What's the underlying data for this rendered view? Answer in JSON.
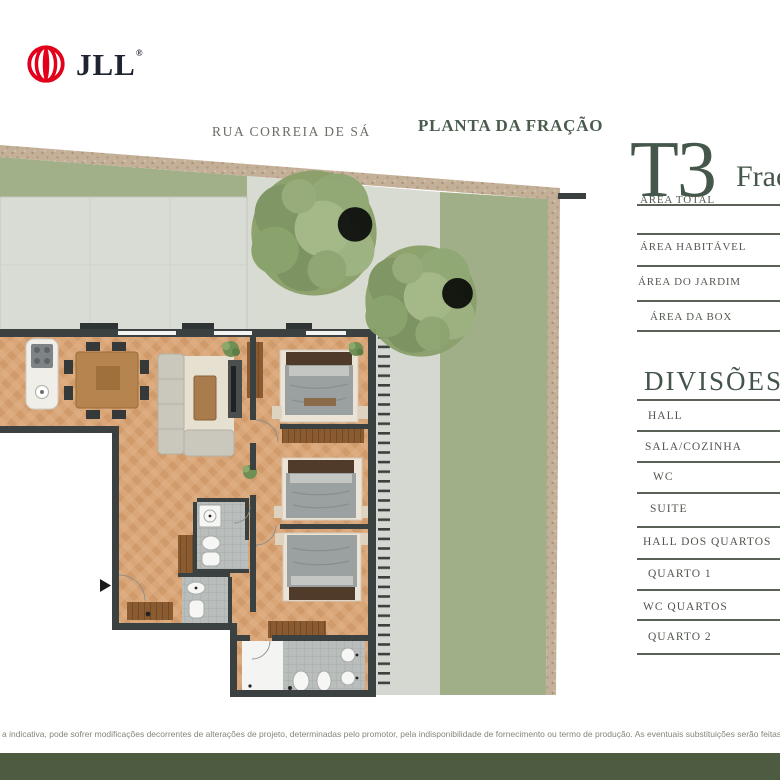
{
  "logo": {
    "brand": "JLL",
    "registered": "®"
  },
  "plan": {
    "street_label": "RUA CORREIA DE SÁ",
    "title": "PLANTA DA FRAÇÃO"
  },
  "sidebar": {
    "typology": "T3",
    "fraction_label": "Fraç",
    "areas": [
      {
        "label": "ÁREA TOTAL"
      },
      {
        "label": "ÁREA HABITÁVEL"
      },
      {
        "label": "ÁREA DO JARDIM"
      },
      {
        "label": "ÁREA DA BOX"
      }
    ],
    "divisions_title": "DIVISÕES",
    "divisions": [
      "HALL",
      "SALA/COZINHA",
      "WC",
      "SUITE",
      "HALL DOS QUARTOS",
      "QUARTO 1",
      "WC QUARTOS",
      "QUARTO 2"
    ]
  },
  "footer": {
    "disclaimer": "a indicativa, pode sofrer modificações decorrentes de alterações de projeto, determinadas pelo promotor, pela indisponibilidade de fornecimento ou termo de produção. As eventuais substituições serão feitas respe",
    "bar_color": "#4d5b41"
  },
  "colors": {
    "brand_red": "#e2001a",
    "brand_navy": "#1e2430",
    "heading_green": "#45574a",
    "label_gray": "#545a51",
    "wall_dark": "#3b4040",
    "wood_floor": "#d9a678",
    "patio_gray": "#d9dbd5",
    "garden_green": "#a0af87",
    "stone_wall": "#c4b099",
    "footer_green": "#4d5b41"
  }
}
